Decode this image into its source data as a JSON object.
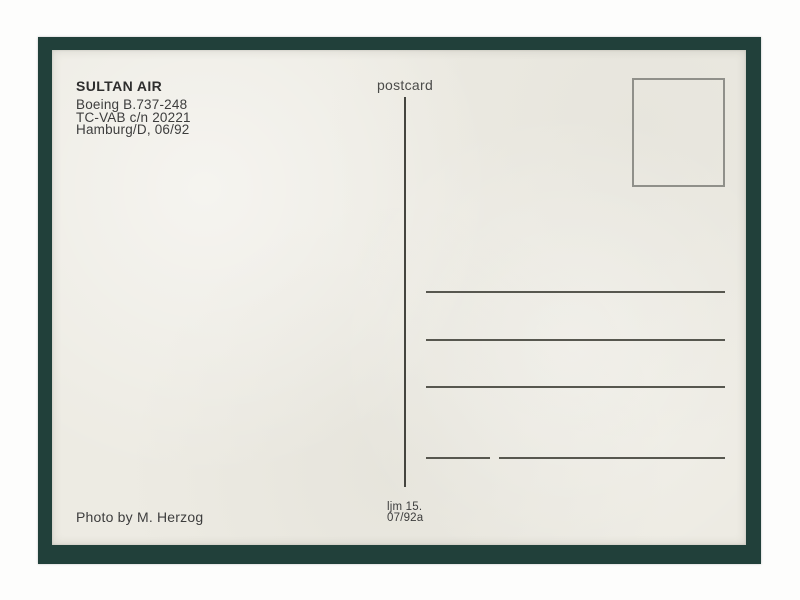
{
  "postcard": {
    "publisher": {
      "airline": "SULTAN AIR",
      "aircraft": "Boeing B.737-248",
      "registration": "TC-VAB c/n 20221",
      "location_date": "Hamburg/D, 06/92"
    },
    "postcard_label": "postcard",
    "photo_credit": "Photo by M. Herzog",
    "edition": {
      "series": "ljm 15.",
      "code": "07/92a"
    },
    "address_ruled_lines": 4,
    "colors": {
      "frame_green": "#21403a",
      "card_cream": "#edebe3",
      "ink": "#3d3d3d",
      "rule_line": "#57574f",
      "stamp_box_border": "#90908a",
      "scan_background": "#fdfdfc"
    }
  }
}
